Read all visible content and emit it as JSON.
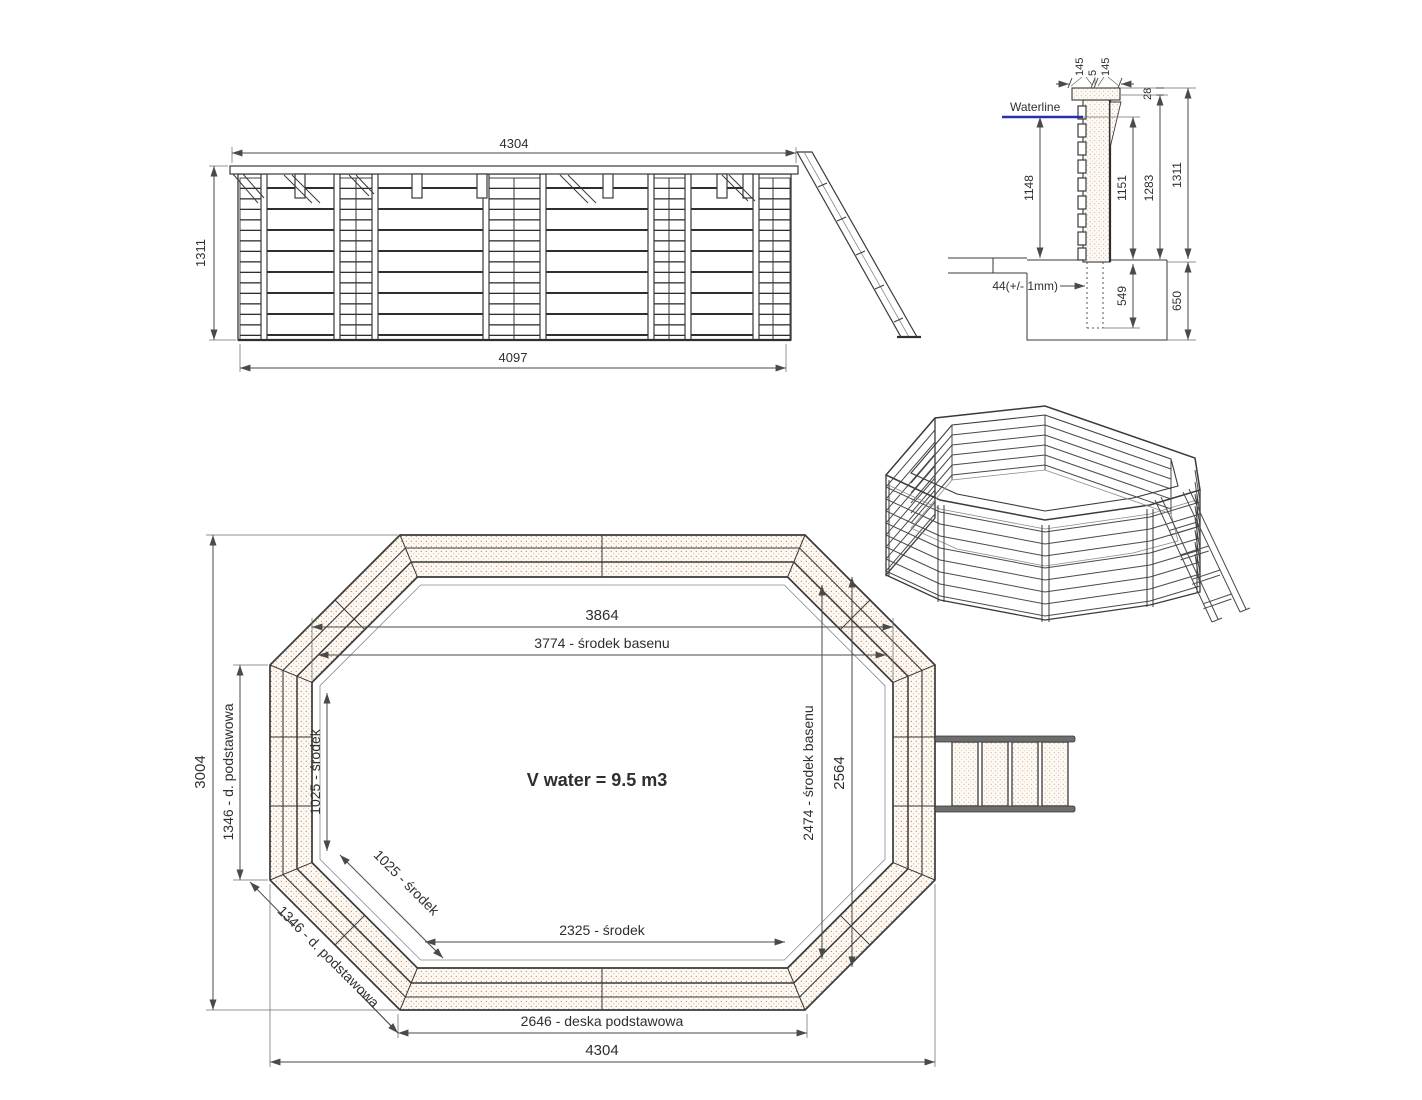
{
  "colors": {
    "line": "#3a3a3a",
    "dimension": "#4a4a4a",
    "hatch_dots": "#c8895c",
    "waterline": "#2b2fa8"
  },
  "elevation": {
    "width_top": "4304",
    "height_left": "1311",
    "width_bottom": "4097"
  },
  "section": {
    "waterline_label": "Waterline",
    "cap_left": "145",
    "cap_gap": "5",
    "cap_right": "145",
    "rim_offset": "28",
    "water_depth_left": "1148",
    "water_depth_right": "1151",
    "wall_inner_height": "1283",
    "wall_total_height": "1311",
    "plank_note": "44(+/- 1mm)",
    "post_embed": "549",
    "foundation_depth": "650"
  },
  "plan": {
    "inner_width": "3864",
    "center_width": "3774 - środek basenu",
    "outer_height": "3004",
    "left_side": "1346 - d. podstawowa",
    "left_center": "1025 - środek",
    "diag_center": "1025 - środek",
    "diag_side": "1346 - d. podstawowa",
    "volume": "V water = 9.5 m3",
    "inner_height": "2564",
    "center_height": "2474 - środek basenu",
    "bottom_center": "2325 - środek",
    "bottom_plank": "2646 - deska podstawowa",
    "outer_width": "4304"
  }
}
